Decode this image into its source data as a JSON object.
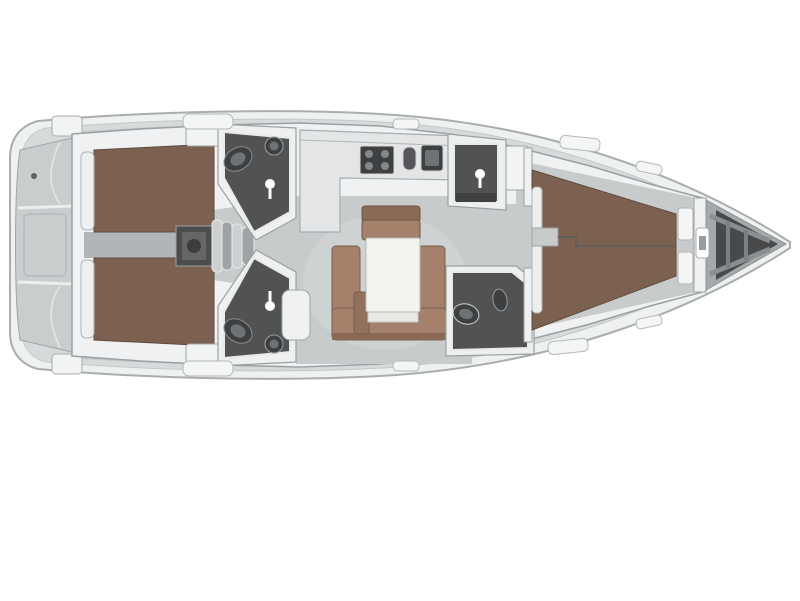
{
  "page": {
    "title": "Sailing yacht interior layout plan — top view, bow to the right"
  },
  "vessel": {
    "view": "top-down floor plan",
    "orientation": "bow-right"
  },
  "palette": {
    "background": "#ffffff",
    "hull_rim": "#eff1f1",
    "hull_stroke": "#a8adaf",
    "deck": "#d7dadb",
    "cabin_wall": "#f0f1f2",
    "floor": "#c8cbcc",
    "floor_dark": "#b2b5b7",
    "floor_light": "#d2d5d6",
    "berth": "#7d6150",
    "berth_stroke": "#5f4a3c",
    "settee": "#a5816c",
    "settee_dark": "#8a6a55",
    "stool": "#93705b",
    "table": "#f2f2ef",
    "counter": "#e3e5e6",
    "head_floor": "#515254",
    "fixture": "#3e3f41",
    "fixture_mid": "#6f7274",
    "steps_light": "#cdd0d1",
    "steps_dark": "#a0a3a5",
    "engine": "#4c4d4f",
    "stern_locker": "#c9cdce",
    "bow_deck": "#a6a9ab",
    "bow_locker": "#48494b",
    "hatch": "#f4f5f5",
    "white": "#ffffff"
  },
  "regions": {
    "stern_lockers": "stern cockpit lockers",
    "aft_cabin_top": "aft double cabin (top)",
    "aft_cabin_bottom": "aft double cabin (bottom)",
    "aft_head_top": "aft head with shower (top)",
    "aft_head_bottom": "aft head with shower (bottom)",
    "companionway": "companionway steps and engine box",
    "galley": "L-shaped galley with stove and twin sinks",
    "salon": "salon with U-settee and folding table",
    "fwd_shower": "forward shower compartment",
    "fwd_head": "forward head",
    "owner_cabin": "forward owner cabin double berth",
    "bow_locker": "anchor / bow locker"
  }
}
